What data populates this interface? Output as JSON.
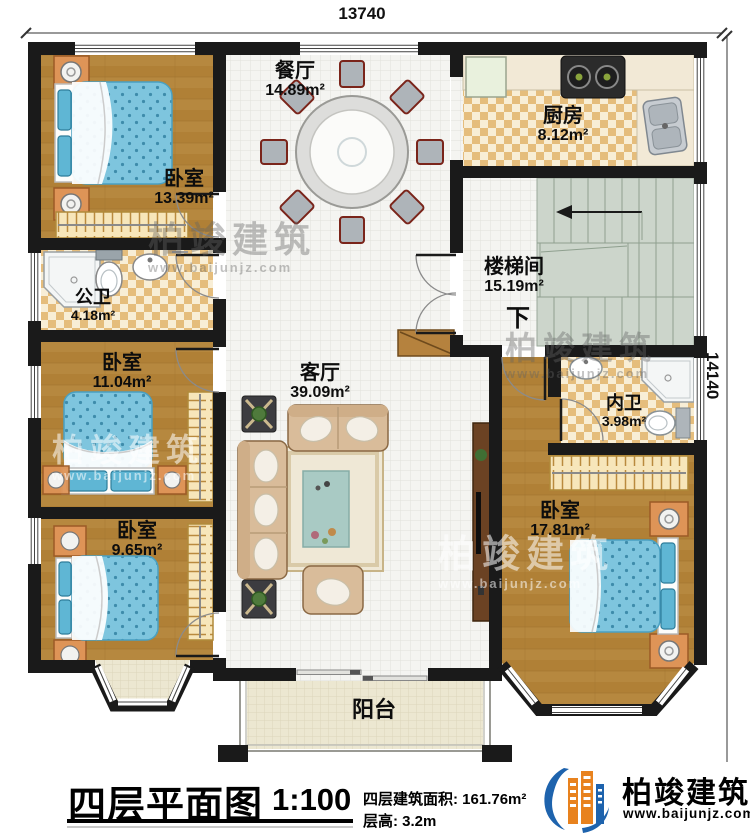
{
  "dimensions": {
    "top": "13740",
    "right": "14140"
  },
  "rooms": {
    "dining": {
      "name": "餐厅",
      "area": "14.89m²"
    },
    "kitchen": {
      "name": "厨房",
      "area": "8.12m²"
    },
    "bedroom_top_left": {
      "name": "卧室",
      "area": "13.39m²"
    },
    "public_bath": {
      "name": "公卫",
      "area": "4.18m²"
    },
    "stairwell": {
      "name": "楼梯间",
      "area": "15.19m²",
      "down_label": "下"
    },
    "bedroom_mid_left": {
      "name": "卧室",
      "area": "11.04m²"
    },
    "living": {
      "name": "客厅",
      "area": "39.09m²"
    },
    "ensuite_bath": {
      "name": "内卫",
      "area": "3.98m²"
    },
    "bedroom_bottom_left": {
      "name": "卧室",
      "area": "9.65m²"
    },
    "bedroom_bottom_right": {
      "name": "卧室",
      "area": "17.81m²"
    },
    "balcony": {
      "name": "阳台"
    }
  },
  "title_block": {
    "title": "四层平面图",
    "scale": "1:100",
    "area_line": "四层建筑面积: 161.76m²",
    "height_line": "层高: 3.2m"
  },
  "brand": {
    "name": "柏竣建筑",
    "url": "www.baijunjz.com"
  },
  "watermark": {
    "text": "柏竣建筑",
    "url": "www.baijunjz.com"
  },
  "colors": {
    "wall": "#1a1a1a",
    "wood_floor": "#b6883f",
    "tile_floor": "#f4f4f1",
    "checker": "#e5bd7c",
    "stairs": "#ccd5cb",
    "bed": "#7ec5de",
    "brand_blue": "#1e63ad",
    "brand_orange": "#e8821e"
  }
}
